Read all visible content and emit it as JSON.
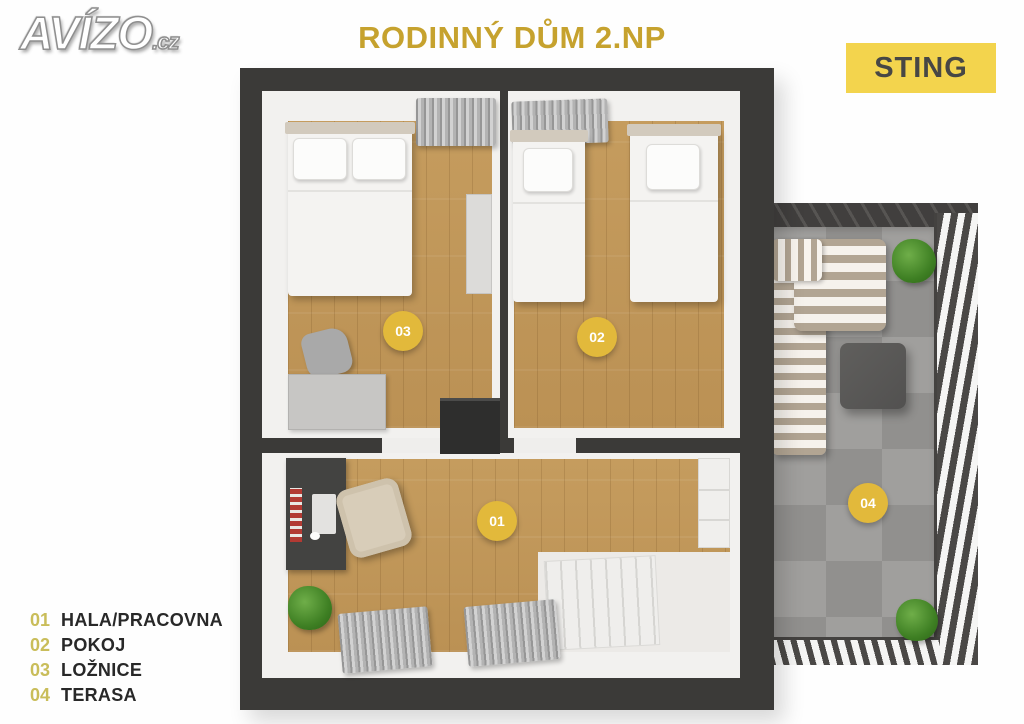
{
  "header": {
    "logo_text": "AVÍZO",
    "logo_suffix": ".cz",
    "title": "RODINNÝ DŮM 2.NP",
    "brand_badge": "STING"
  },
  "legend": {
    "items": [
      {
        "number": "01",
        "label": "HALA/PRACOVNA"
      },
      {
        "number": "02",
        "label": "POKOJ"
      },
      {
        "number": "03",
        "label": "LOŽNICE"
      },
      {
        "number": "04",
        "label": "TERASA"
      }
    ]
  },
  "colors": {
    "accent_gold": "#c6a22e",
    "legend_number_gold": "#c9bd5a",
    "marker_yellow": "#e2b93b",
    "sting_badge_bg": "#f3d44d",
    "sting_badge_text": "#474745",
    "wall_dark": "#3b3a38",
    "wood_floor": "#c59c5e",
    "terrace_tile": "#9c9b99",
    "curtain_gray": "#b3b3b3",
    "sofa_stripe": "#b2a593",
    "plant_green": "#3e7f23"
  }
}
